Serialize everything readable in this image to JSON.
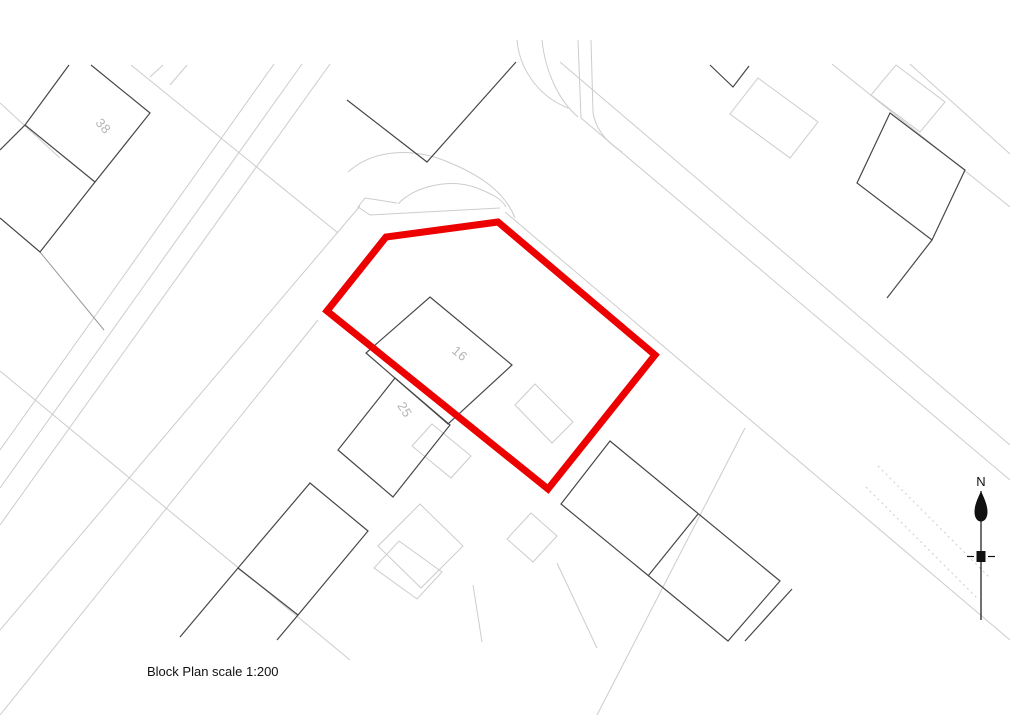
{
  "plan": {
    "caption": "Block Plan scale 1:200",
    "north_label": "N",
    "colors": {
      "site_boundary": "#ec0000",
      "building_line": "#474747",
      "map_line": "#cccccc",
      "label_gray": "#b5b5b5"
    },
    "plot_labels": [
      {
        "text": "38"
      },
      {
        "text": "16"
      },
      {
        "text": "25"
      }
    ]
  }
}
